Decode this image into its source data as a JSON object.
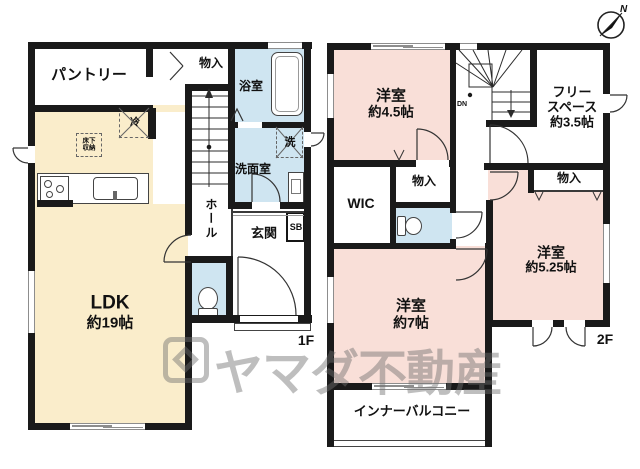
{
  "floors": {
    "f1": {
      "label": "1F",
      "rooms": {
        "pantry": "パントリー",
        "closet": "物入",
        "bath": "浴室",
        "washer": "洗",
        "washroom": "洗面室",
        "fridge": "冷",
        "underfloor1": "床下",
        "underfloor2": "収納",
        "hall": "ホール",
        "entrance": "玄関",
        "shoe_box": "SB",
        "ldk1": "LDK",
        "ldk2": "約19帖"
      }
    },
    "f2": {
      "label": "2F",
      "rooms": {
        "bedroom45_1": "洋室",
        "bedroom45_2": "約4.5帖",
        "free1": "フリー",
        "free2": "スペース",
        "free3": "約3.5帖",
        "down": "DN",
        "wic": "WIC",
        "closet_left": "物入",
        "closet_right": "物入",
        "bedroom7_1": "洋室",
        "bedroom7_2": "約7帖",
        "bedroom525_1": "洋室",
        "bedroom525_2": "約5.25帖",
        "balcony": "インナーバルコニー"
      }
    }
  },
  "compass": {
    "north": "N"
  },
  "watermark": {
    "brand": "ヤマダ不動産"
  },
  "colors": {
    "wall": "#1A1A1A",
    "ldk_fill": "#FAEDCB",
    "bedroom_fill": "#F9DFD8",
    "wet_area_fill": "#CFE5F1",
    "watermark_gray": "rgba(110,110,110,0.45)"
  }
}
